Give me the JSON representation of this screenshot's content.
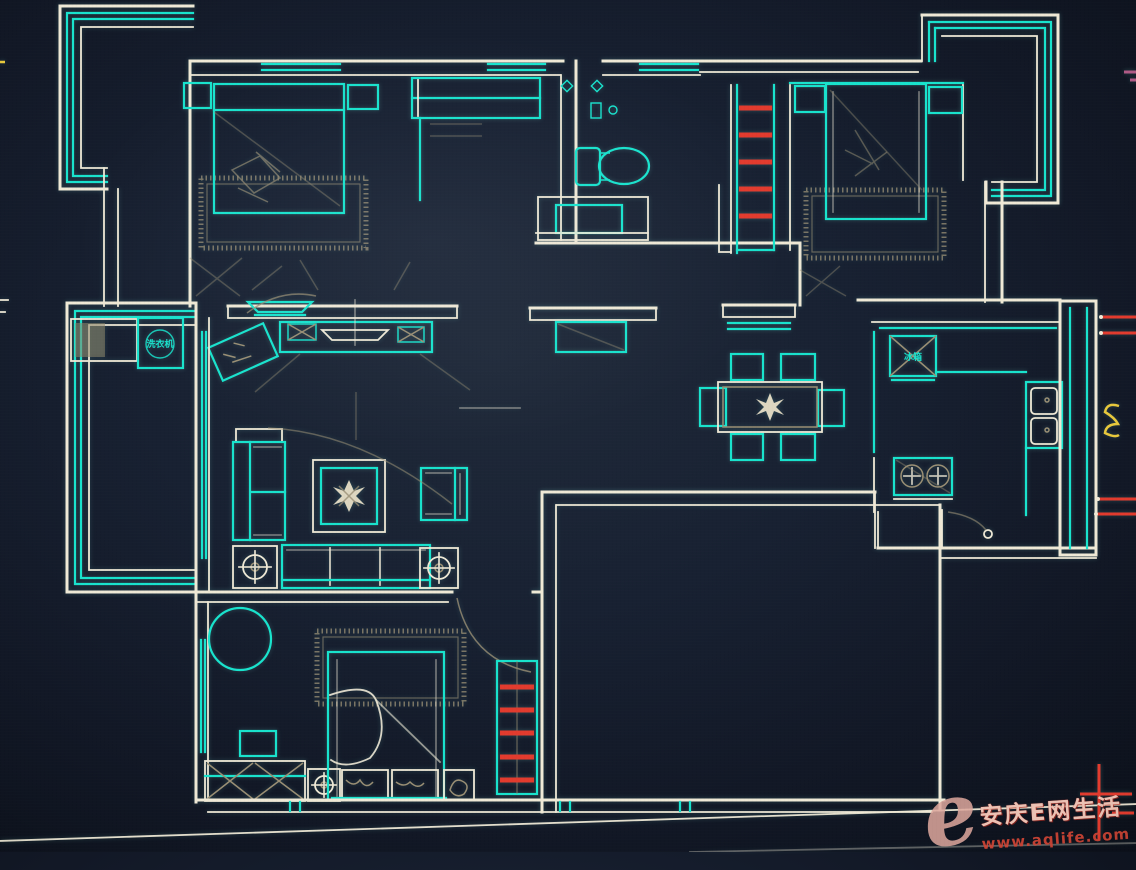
{
  "labels": {
    "washing_machine": "洗衣机",
    "fridge": "冰箱"
  },
  "watermark": {
    "logo_letter": "e",
    "site_name": "安庆E网生活",
    "url": "www.aqlife.com"
  },
  "colors": {
    "background": "#141b27",
    "wall_line": "#efe9d6",
    "fixture_line": "#19e3cd",
    "accent_red": "#e23b2e",
    "detail_tan": "#9a8f74",
    "highlight_yellow": "#e8c83c",
    "watermark_pink": "#dfa89e",
    "watermark_red": "#cc4435"
  }
}
